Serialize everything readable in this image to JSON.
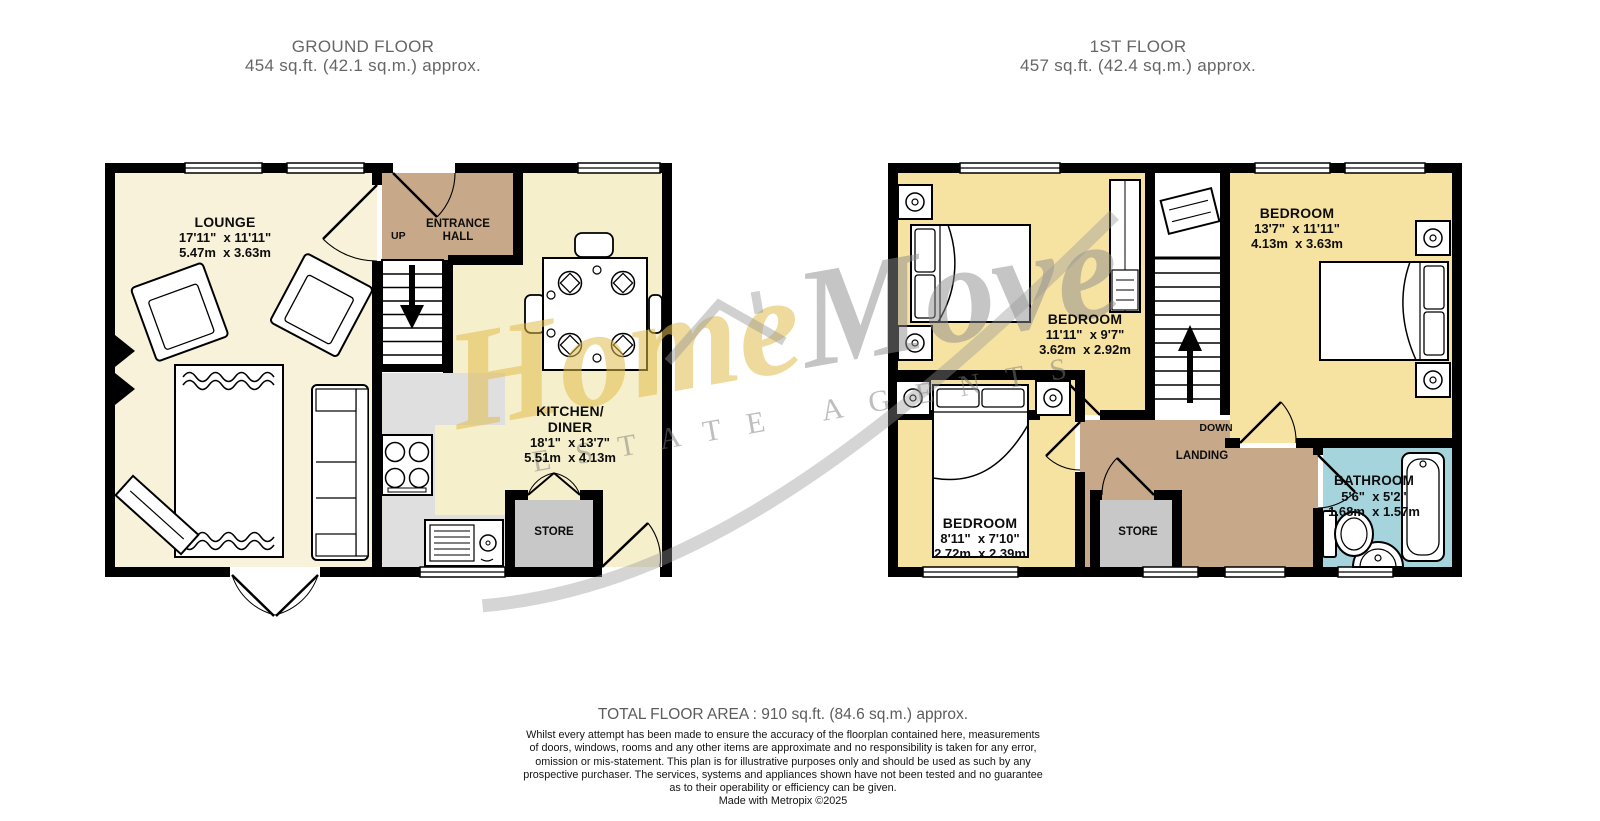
{
  "ground_floor": {
    "title": "GROUND FLOOR",
    "subtitle": "454 sq.ft. (42.1 sq.m.) approx.",
    "rooms": {
      "lounge": {
        "name": "LOUNGE",
        "imperial": "17'11\"  x 11'11\"",
        "metric": "5.47m  x 3.63m"
      },
      "entrance_hall": {
        "line1": "ENTRANCE",
        "line2": "HALL"
      },
      "kitchen": {
        "line1": "KITCHEN/",
        "line2": "DINER",
        "imperial": "18'1\"  x 13'7\"",
        "metric": "5.51m  x 4.13m"
      },
      "store": {
        "name": "STORE"
      },
      "up_label": "UP"
    }
  },
  "first_floor": {
    "title": "1ST FLOOR",
    "subtitle": "457 sq.ft. (42.4 sq.m.) approx.",
    "rooms": {
      "bedroom_main": {
        "name": "BEDROOM",
        "imperial": "13'7\"  x 11'11\"",
        "metric": "4.13m  x 3.63m"
      },
      "bedroom_mid": {
        "name": "BEDROOM",
        "imperial": "11'11\"  x 9'7\"",
        "metric": "3.62m  x 2.92m"
      },
      "bedroom_small": {
        "name": "BEDROOM",
        "imperial": "8'11\"  x 7'10\"",
        "metric": "2.72m  x 2.39m"
      },
      "bathroom": {
        "name": "BATHROOM",
        "imperial": "5'6\"  x 5'2\"",
        "metric": "1.68m  x 1.57m"
      },
      "landing": {
        "name": "LANDING"
      },
      "store": {
        "name": "STORE"
      },
      "down_label": "DOWN"
    }
  },
  "watermark": {
    "logo_part1": "Home",
    "logo_part2": "Move",
    "tagline": "ESTATE AGENTS"
  },
  "footer": {
    "total": "TOTAL FLOOR AREA : 910 sq.ft. (84.6 sq.m.) approx.",
    "lines": [
      "Whilst every attempt has been made to ensure the accuracy of the floorplan contained here, measurements",
      "of doors, windows, rooms and any other items are approximate and no responsibility is taken for any error,",
      "omission or mis-statement. This plan is for illustrative purposes only and should be used as such by any",
      "prospective purchaser. The services, systems and appliances shown have not been tested and no guarantee",
      "as to their operability or efficiency can be given.",
      "Made with Metropix ©2025"
    ]
  },
  "colors": {
    "wall": "#000000",
    "lounge_floor": "#F8F2DA",
    "kitchen_floor": "#F6EFCB",
    "hall_landing_floor": "#C7A98A",
    "bedroom_floor": "#F6E3A2",
    "bathroom_floor": "#A6D4DC",
    "store_floor": "#C8C8C8",
    "counter": "#DFDFDF",
    "watermark_gold": "#E0BB4A",
    "watermark_gray": "#8C8C8C",
    "title_gray": "#666666"
  }
}
